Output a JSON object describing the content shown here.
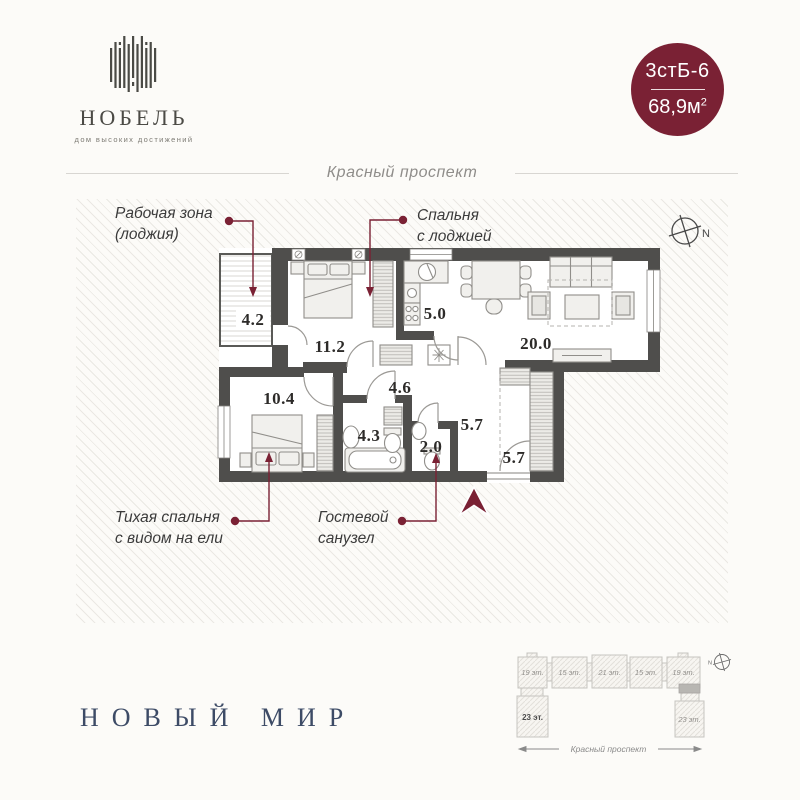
{
  "brand": {
    "name": "НОБЕЛЬ",
    "tagline": "дом высоких достижений"
  },
  "badge": {
    "unit": "3стБ-6",
    "area": "68,9м",
    "area_sup": "2"
  },
  "street": {
    "top": "Красный проспект"
  },
  "plan": {
    "compass_n": "N",
    "rooms": {
      "loggia": "4.2",
      "bedroom1": "11.2",
      "kitchen": "5.0",
      "living": "20.0",
      "bedroom2": "10.4",
      "hall": "4.6",
      "bath": "4.3",
      "wc": "2.0",
      "hall_a": "5.7",
      "hall_b": "5.7"
    },
    "annotations": {
      "work_zone_1": "Рабочая зона",
      "work_zone_2": "(лоджия)",
      "bedroom_1": "Спальня",
      "bedroom_2": "с лоджией",
      "quiet_1": "Тихая спальня",
      "quiet_2": "с видом на ели",
      "guest_1": "Гостевой",
      "guest_2": "санузел"
    }
  },
  "site_plan": {
    "blocks": [
      "19 эт.",
      "15 эт.",
      "21 эт.",
      "15 эт.",
      "19 эт."
    ],
    "tower_left": "23 эт.",
    "tower_right": "23 эт.",
    "street": "Красный проспект",
    "compass": "N"
  },
  "footer": {
    "developer": "НОВЫЙ МИР"
  },
  "colors": {
    "accent": "#7a2134",
    "wall": "#4f4e4c",
    "navy": "#3d4b66"
  }
}
